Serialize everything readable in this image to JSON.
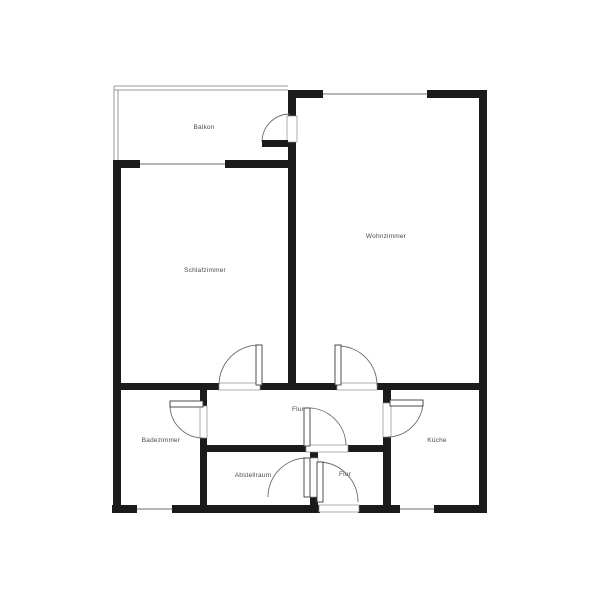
{
  "document": {
    "type": "apartment-floor-plan",
    "background": "#ffffff"
  },
  "colors": {
    "wall": "#1b1b1b",
    "window_line": "#8c8c8c",
    "railing_line": "#9a9a9a",
    "door_arc": "#6b6b6b",
    "door_leaf_stroke": "#3c3c3c",
    "frame_stroke": "#8a8a8a",
    "label": "#4a4a4a"
  },
  "rooms": [
    {
      "id": "balkon",
      "label": "Balkon",
      "x": 204,
      "y": 129
    },
    {
      "id": "wohnzimmer",
      "label": "Wohnzimmer",
      "x": 386,
      "y": 238
    },
    {
      "id": "schlafzimmer",
      "label": "Schlafzimmer",
      "x": 205,
      "y": 272
    },
    {
      "id": "badezimmer",
      "label": "Badezimmer",
      "x": 161,
      "y": 442
    },
    {
      "id": "flur",
      "label": "Flur",
      "x": 298,
      "y": 411
    },
    {
      "id": "kueche",
      "label": "Küche",
      "x": 437,
      "y": 442
    },
    {
      "id": "abstellraum",
      "label": "Abstellraum",
      "x": 253,
      "y": 477
    },
    {
      "id": "flur-eingang",
      "label": "Flur",
      "x": 345,
      "y": 476
    }
  ],
  "floorplan": {
    "canvas": {
      "width": 600,
      "height": 600
    },
    "walls": [
      [
        288,
        90,
        35,
        8
      ],
      [
        427,
        90,
        60,
        8
      ],
      [
        479,
        90,
        8,
        423
      ],
      [
        112,
        505,
        25,
        8
      ],
      [
        172,
        505,
        148,
        8
      ],
      [
        358,
        505,
        42,
        8
      ],
      [
        434,
        505,
        53,
        8
      ],
      [
        113,
        160,
        8,
        353
      ],
      [
        113,
        160,
        27,
        8
      ],
      [
        225,
        160,
        71,
        8
      ],
      [
        288,
        98,
        8,
        18
      ],
      [
        288,
        142,
        8,
        241
      ],
      [
        113,
        383,
        106,
        7
      ],
      [
        260,
        383,
        77,
        7
      ],
      [
        377,
        383,
        110,
        7
      ],
      [
        200,
        390,
        7,
        16
      ],
      [
        200,
        438,
        7,
        67
      ],
      [
        200,
        445,
        106,
        7
      ],
      [
        348,
        445,
        42,
        7
      ],
      [
        310,
        452,
        8,
        6
      ],
      [
        310,
        497,
        8,
        8
      ],
      [
        383,
        390,
        8,
        13
      ],
      [
        383,
        437,
        8,
        68
      ]
    ],
    "windows": [
      [
        140,
        164,
        225,
        164
      ],
      [
        323,
        94,
        427,
        94
      ],
      [
        137,
        509,
        172,
        509
      ],
      [
        400,
        509,
        434,
        509
      ]
    ],
    "railings": [
      [
        114,
        86,
        288,
        86
      ],
      [
        114,
        90,
        288,
        90
      ],
      [
        114,
        86,
        114,
        160
      ],
      [
        118,
        90,
        118,
        160
      ]
    ],
    "door_frames": [
      [
        287,
        116,
        10,
        26
      ],
      [
        219,
        383,
        41,
        7
      ],
      [
        337,
        383,
        40,
        7
      ],
      [
        200,
        406,
        7,
        32
      ],
      [
        383,
        403,
        8,
        34
      ],
      [
        306,
        445,
        42,
        7
      ],
      [
        310,
        458,
        8,
        39
      ],
      [
        319,
        505,
        40,
        7
      ]
    ],
    "door_arcs": [
      "M262,142 A28,28 0 0 1 290,114",
      "M219,385 A40,40 0 0 1 259,345",
      "M338,346 A39,39 0 0 1 377,385",
      "M170,405 A33,33 0 0 0 203,438",
      "M423,403 A36,36 0 0 1 387,437",
      "M307,408 A38,38 0 0 1 346,445",
      "M307,458 A39,39 0 0 0 268,497",
      "M320,462 A40,40 0 0 1 358,502"
    ],
    "door_leaves": [
      [
        256,
        345,
        6,
        40
      ],
      [
        335,
        345,
        6,
        40
      ],
      [
        170,
        401,
        33,
        6
      ],
      [
        390,
        400,
        33,
        6
      ],
      [
        304,
        408,
        6,
        38
      ],
      [
        304,
        458,
        6,
        39
      ],
      [
        317,
        462,
        6,
        40
      ]
    ],
    "door_leaves_dark": [
      [
        262,
        140,
        26,
        7
      ]
    ]
  }
}
